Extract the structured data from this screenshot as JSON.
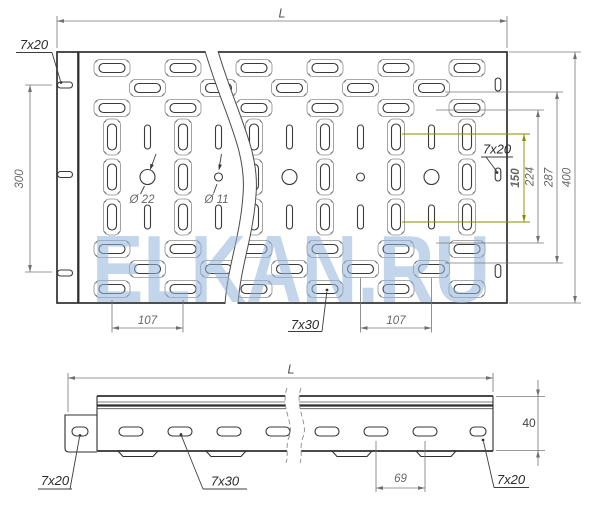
{
  "watermark": {
    "text": "ELKAN.RU"
  },
  "colors": {
    "highlight_dim": "#8b8b00",
    "watermark_blue": "#93b4dc",
    "drawing_line": "#2f2f2f",
    "dimension_gray": "#6f6f6f"
  },
  "top_view": {
    "length_dim": "L",
    "flange_slot_callout": "7x20",
    "flange_slot_spacing_dim": "300",
    "large_hole_callout": "Ø 22",
    "small_hole_callout": "Ø 11",
    "edge_slot_callout": "7x20",
    "slot_row_spacing_dim": "150",
    "row_spacing_inner_dim": "224",
    "row_spacing_outer_dim": "287",
    "width_dim": "400",
    "pitch_left_dim": "107",
    "main_slot_callout": "7x30",
    "pitch_right_dim": "107"
  },
  "side_view": {
    "length_dim": "L",
    "height_dim": "40",
    "slot_pitch_dim": "69",
    "left_slot_callout": "7x20",
    "middle_slot_callout": "7x30",
    "right_slot_callout": "7x20"
  }
}
